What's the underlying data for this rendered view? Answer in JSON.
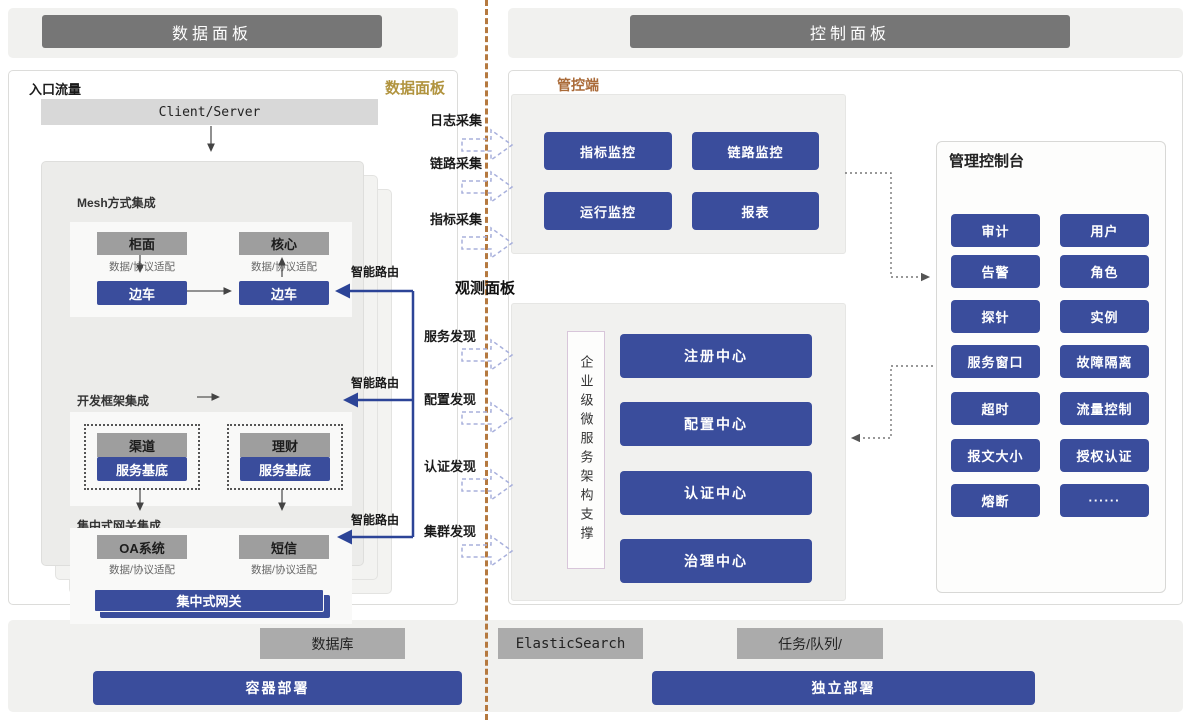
{
  "headers": {
    "data_panel": "数据面板",
    "control_panel": "控制面板"
  },
  "data_panel": {
    "entry_label": "入口流量",
    "corner_label": "数据面板",
    "client_server": "Client/Server",
    "smart_route": "智能路由",
    "sections": {
      "mesh": {
        "title": "Mesh方式集成",
        "top_left": "柜面",
        "top_right": "核心",
        "adapter": "数据/协议适配",
        "sidecar": "边车"
      },
      "framework": {
        "title": "开发框架集成",
        "top_left": "渠道",
        "top_right": "理财",
        "base": "服务基底"
      },
      "gateway": {
        "title": "集中式网关集成",
        "top_left": "OA系统",
        "top_right": "短信",
        "adapter": "数据/协议适配",
        "bar": "集中式网关"
      }
    }
  },
  "middle": {
    "collect": [
      "日志采集",
      "链路采集",
      "指标采集"
    ],
    "observe_title": "观测面板",
    "discover": [
      "服务发现",
      "配置发现",
      "认证发现",
      "集群发现"
    ]
  },
  "control_panel": {
    "manage_label": "管控端",
    "monitor_buttons": [
      "指标监控",
      "链路监控",
      "运行监控",
      "报表"
    ],
    "support_label": "企业级微服务架构支撑",
    "centers": [
      "注册中心",
      "配置中心",
      "认证中心",
      "治理中心"
    ],
    "console": {
      "title": "管理控制台",
      "items": [
        "审计",
        "用户",
        "告警",
        "角色",
        "探针",
        "实例",
        "服务窗口",
        "故障隔离",
        "超时",
        "流量控制",
        "报文大小",
        "授权认证",
        "熔断",
        "······"
      ]
    }
  },
  "footer": {
    "database": "数据库",
    "elasticsearch": "ElasticSearch",
    "task_queue": "任务/队列/",
    "container_deploy": "容器部署",
    "standalone_deploy": "独立部署"
  },
  "colors": {
    "primary_blue": "#3a4d9c",
    "header_gray": "#767676",
    "node_gray": "#9e9e9e",
    "light_gray": "#d8d8d8",
    "gold": "#b1943f",
    "orange": "#aa6a38",
    "divider_brown": "#b5793f",
    "dashed_arrow_blue": "#a8b0dc",
    "route_blue": "#2c4497"
  }
}
